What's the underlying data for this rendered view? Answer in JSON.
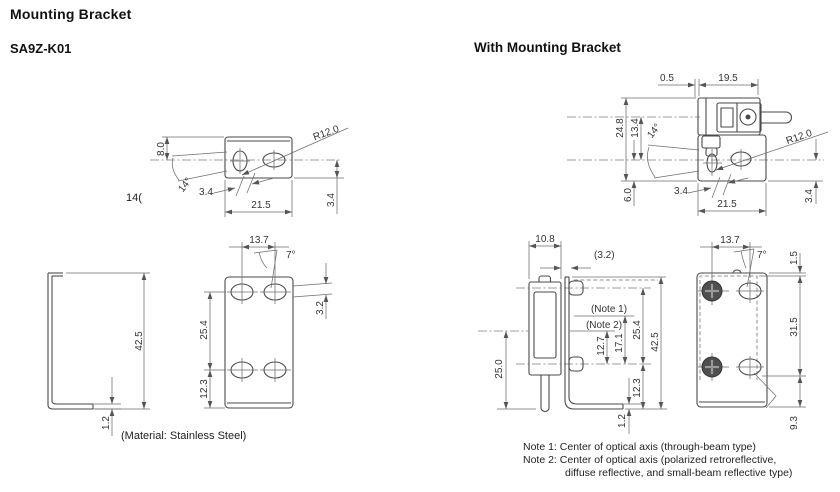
{
  "header": {
    "title": "Mounting Bracket",
    "model": "SA9Z-K01",
    "right_title": "With Mounting Bracket"
  },
  "misc": {
    "stray_label": "14(",
    "material": "(Material: Stainless Steel)"
  },
  "notes": {
    "line1": "Note 1: Center of optical axis (through-beam type)",
    "line2": "Note 2: Center of optical axis (polarized retroreflective,",
    "line3": "diffuse reflective, and small-beam reflective type)"
  },
  "bracket_top": {
    "height": "8.0",
    "angle": "14°",
    "hole_pitch": "3.4",
    "width": "21.5",
    "radius": "R12.0",
    "offset": "3.4"
  },
  "bracket_side": {
    "height": "42.5",
    "thickness": "1.2"
  },
  "bracket_front": {
    "width": "13.7",
    "angle": "7°",
    "pitch_upper": "25.4",
    "pitch_lower": "12.3",
    "offset": "3.2"
  },
  "assembly_top": {
    "gap": "0.5",
    "sensor_width": "19.5",
    "height_total": "24.8",
    "height_axis": "13.4",
    "angle": "14°",
    "height_lower": "6.0",
    "hole_pitch": "3.4",
    "width": "21.5",
    "radius": "R12.0",
    "offset": "3.4"
  },
  "assembly_side": {
    "sensor_depth": "10.8",
    "plate_ref": "(3.2)",
    "note1_label": "(Note 1)",
    "note2_label": "(Note 2)",
    "axis2_to_hole": "12.7",
    "axis1_to_hole": "17.1",
    "hole_pitch": "25.4",
    "height": "42.5",
    "axis_to_bottom": "25.0",
    "hole_to_bottom": "12.3",
    "thickness": "1.2"
  },
  "assembly_front": {
    "width": "13.7",
    "angle": "7°",
    "top_gap": "1.5",
    "sensor_height": "31.5",
    "bottom": "9.3"
  }
}
